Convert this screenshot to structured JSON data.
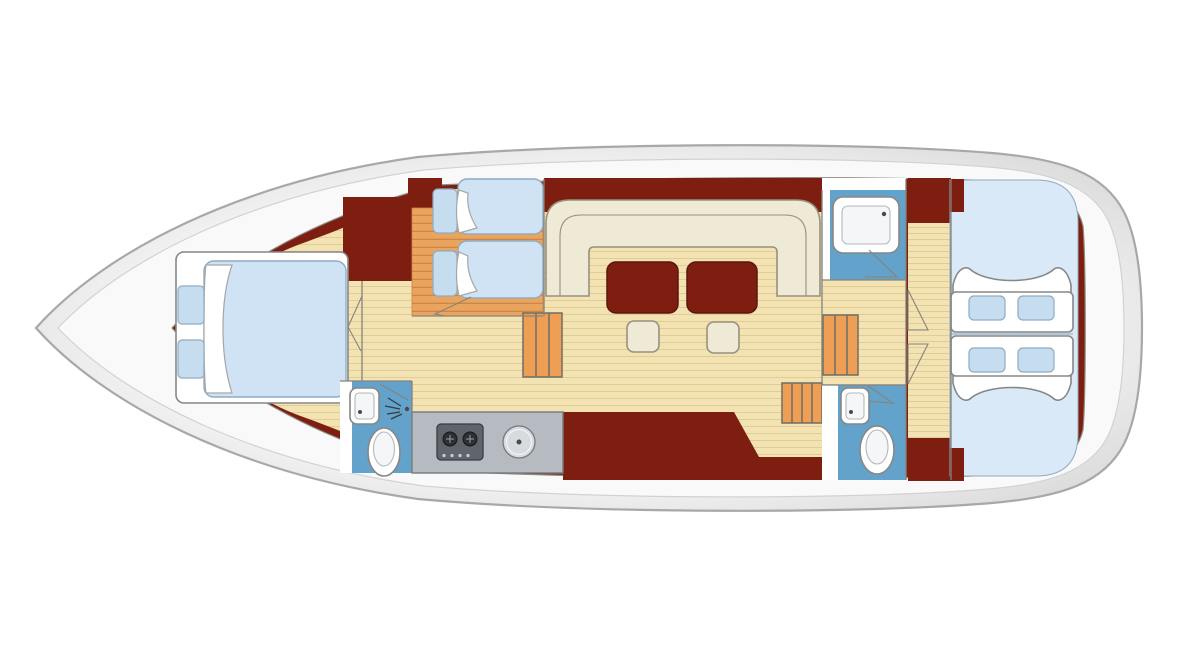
{
  "diagram": {
    "type": "boat-floor-plan",
    "orientation": "bow-left-stern-right",
    "colors": {
      "hull_light": "#fbfbfb",
      "hull_shade": "#dcdcdc",
      "hull_inner": "#f9f9f9",
      "hull_inner_line": "#d2d2d2",
      "hull_stroke": "#a8a8a8",
      "interior": "#7e1e10",
      "interior_edge": "#8d8d85",
      "wood": "#f3e3b2",
      "wood_line": "#e0cc97",
      "wood_orange": "#e9a55f",
      "wood_orange_line": "#cc8342",
      "step_face": "#ef9f55",
      "step_line": "#6e6e66",
      "bath_floor": "#63a2ca",
      "wall": "#ffffff",
      "wall_line": "#84847c",
      "mattress": "#cfe3f4",
      "mattress_stroke": "#90abc2",
      "cabin_bg": "#d9e9f7",
      "cushion": "#c6ddf0",
      "seat_gap": "#a8bdd0",
      "pillow_stroke": "#a6a6a6",
      "cream": "#efead6",
      "cream_stroke": "#97917f",
      "table": "#7e1e10",
      "table_stroke": "#5c150a",
      "counter": "#b6bac1",
      "counter_stroke": "#75797f",
      "stove": "#5f656b",
      "stove_stroke": "#383d42",
      "burner": "#2d3135",
      "knob": "#c9ced4",
      "sink_steel": "#d7dbe0",
      "fixture": "#ffffff",
      "fixture_stroke": "#878787",
      "fixture_inner": "#f4f6f8",
      "fixture_inner_line": "#b4b7bb",
      "drain": "#4a4a4a"
    },
    "rooms": [
      {
        "id": "forward-cabin"
      },
      {
        "id": "guest-cabin-bunks"
      },
      {
        "id": "bathroom-forward"
      },
      {
        "id": "galley"
      },
      {
        "id": "salon"
      },
      {
        "id": "shower-room-aft"
      },
      {
        "id": "bathroom-aft"
      },
      {
        "id": "corridor-aft"
      },
      {
        "id": "aft-cabin"
      }
    ],
    "furniture_icons": [
      "double-bed",
      "nightstand",
      "pillow",
      "bunk-bed",
      "sheet-fold",
      "washbasin-icon",
      "toilet-icon",
      "shower-spray-icon",
      "shower-tray",
      "stove-icon",
      "round-sink-icon",
      "u-sofa",
      "table",
      "stool",
      "steps-ladder",
      "bench-seat",
      "seat-cushion",
      "door-swing"
    ]
  }
}
